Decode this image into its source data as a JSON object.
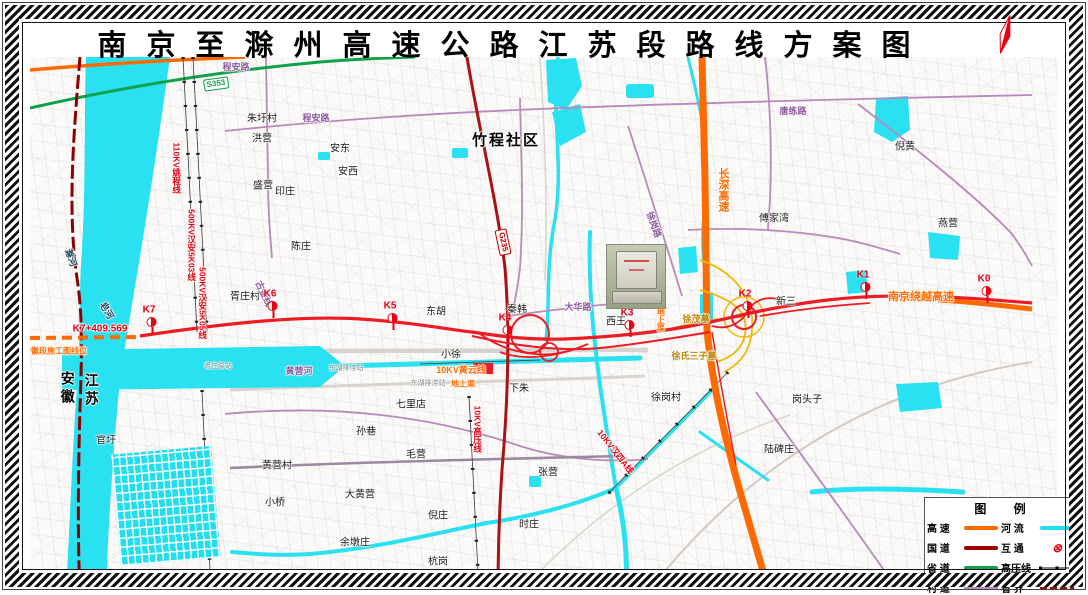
{
  "title": "南京至滁州高速公路江苏段路线方案图",
  "legend": {
    "title": "图 例",
    "items": [
      {
        "label": "高  速",
        "swatch": "line",
        "color": "#ff6a00"
      },
      {
        "label": "河  流",
        "swatch": "line",
        "color": "#22dff0"
      },
      {
        "label": "国  道",
        "swatch": "line",
        "color": "#a00000"
      },
      {
        "label": "互  通",
        "swatch": "interchange",
        "color": "#e60012"
      },
      {
        "label": "省  道",
        "swatch": "line",
        "color": "#11a04c"
      },
      {
        "label": "高压线",
        "swatch": "powerline",
        "color": "#000000"
      },
      {
        "label": "村  道",
        "swatch": "line",
        "color": "#b78ab8"
      },
      {
        "label": "省  界",
        "swatch": "dashed",
        "color": "#a00000"
      }
    ]
  },
  "map": {
    "stations": [
      {
        "id": "K0",
        "x": 987,
        "y": 303
      },
      {
        "id": "K1",
        "x": 866,
        "y": 299
      },
      {
        "id": "K2",
        "x": 748,
        "y": 318
      },
      {
        "id": "K3",
        "x": 630,
        "y": 337
      },
      {
        "id": "K4",
        "x": 508,
        "y": 342
      },
      {
        "id": "K5",
        "x": 393,
        "y": 330
      },
      {
        "id": "K6",
        "x": 273,
        "y": 318
      },
      {
        "id": "K7",
        "x": 152,
        "y": 334
      }
    ],
    "shields": [
      {
        "t": "S353",
        "x": 216,
        "y": 84,
        "cls": "green",
        "r": -8
      },
      {
        "t": "G235",
        "x": 503,
        "y": 242,
        "cls": "red",
        "r": 78
      }
    ],
    "labels": [
      {
        "t": "朱圩村",
        "x": 262,
        "y": 119,
        "c": "v"
      },
      {
        "t": "洪营",
        "x": 262,
        "y": 139,
        "c": "v"
      },
      {
        "t": "安东",
        "x": 340,
        "y": 149,
        "c": "v"
      },
      {
        "t": "安西",
        "x": 348,
        "y": 172,
        "c": "v"
      },
      {
        "t": "盛营",
        "x": 263,
        "y": 186,
        "c": "v"
      },
      {
        "t": "印庄",
        "x": 285,
        "y": 192,
        "c": "v"
      },
      {
        "t": "陈庄",
        "x": 301,
        "y": 247,
        "c": "v"
      },
      {
        "t": "胥庄村",
        "x": 245,
        "y": 297,
        "c": "v"
      },
      {
        "t": "竹程社区",
        "x": 506,
        "y": 141,
        "c": "vb"
      },
      {
        "t": "东胡",
        "x": 436,
        "y": 312,
        "c": "v"
      },
      {
        "t": "小徐",
        "x": 451,
        "y": 355,
        "c": "v"
      },
      {
        "t": "秦韩",
        "x": 517,
        "y": 310,
        "c": "v"
      },
      {
        "t": "西王",
        "x": 616,
        "y": 322,
        "c": "v"
      },
      {
        "t": "新三",
        "x": 786,
        "y": 302,
        "c": "v"
      },
      {
        "t": "傅家湾",
        "x": 774,
        "y": 219,
        "c": "v"
      },
      {
        "t": "燕营",
        "x": 948,
        "y": 224,
        "c": "v"
      },
      {
        "t": "倪黄",
        "x": 905,
        "y": 147,
        "c": "v"
      },
      {
        "t": "下朱",
        "x": 519,
        "y": 389,
        "c": "v"
      },
      {
        "t": "七里店",
        "x": 411,
        "y": 405,
        "c": "v"
      },
      {
        "t": "孙巷",
        "x": 366,
        "y": 432,
        "c": "v"
      },
      {
        "t": "毛营",
        "x": 416,
        "y": 455,
        "c": "v"
      },
      {
        "t": "黄营村",
        "x": 277,
        "y": 466,
        "c": "v"
      },
      {
        "t": "小桥",
        "x": 275,
        "y": 503,
        "c": "v"
      },
      {
        "t": "大黄营",
        "x": 360,
        "y": 495,
        "c": "v"
      },
      {
        "t": "倪庄",
        "x": 438,
        "y": 516,
        "c": "v"
      },
      {
        "t": "余墩庄",
        "x": 355,
        "y": 543,
        "c": "v"
      },
      {
        "t": "杭岗",
        "x": 438,
        "y": 562,
        "c": "v"
      },
      {
        "t": "张营",
        "x": 548,
        "y": 473,
        "c": "v"
      },
      {
        "t": "时庄",
        "x": 529,
        "y": 525,
        "c": "v"
      },
      {
        "t": "徐岗村",
        "x": 666,
        "y": 398,
        "c": "v"
      },
      {
        "t": "岗头子",
        "x": 807,
        "y": 400,
        "c": "v"
      },
      {
        "t": "陆碑庄",
        "x": 779,
        "y": 450,
        "c": "v"
      },
      {
        "t": "官圩",
        "x": 106,
        "y": 441,
        "c": "v"
      },
      {
        "t": "安徽",
        "x": 67,
        "y": 389,
        "c": "prov"
      },
      {
        "t": "江苏",
        "x": 91,
        "y": 391,
        "c": "prov"
      },
      {
        "t": "滁河",
        "x": 70,
        "y": 258,
        "c": "w",
        "r": 70
      },
      {
        "t": "皂河",
        "x": 106,
        "y": 311,
        "c": "w",
        "r": 60
      },
      {
        "t": "黄营河",
        "x": 299,
        "y": 372,
        "c": "p"
      },
      {
        "t": "程安路",
        "x": 236,
        "y": 68,
        "c": "p"
      },
      {
        "t": "程安路",
        "x": 316,
        "y": 119,
        "c": "p"
      },
      {
        "t": "唐练路",
        "x": 793,
        "y": 112,
        "c": "p"
      },
      {
        "t": "大华路",
        "x": 578,
        "y": 308,
        "c": "p"
      },
      {
        "t": "徐岗路",
        "x": 653,
        "y": 225,
        "c": "p",
        "r": 70
      },
      {
        "t": "古金线",
        "x": 263,
        "y": 294,
        "c": "p",
        "r": 65
      },
      {
        "t": "K7+409.569",
        "x": 100,
        "y": 329,
        "c": "r",
        "s": 10
      },
      {
        "t": "110KV姚程线",
        "x": 176,
        "y": 168,
        "c": "r",
        "vert": true
      },
      {
        "t": "500KV汉安5K03线",
        "x": 191,
        "y": 245,
        "c": "r",
        "vert": true
      },
      {
        "t": "500KV汉安5K05线",
        "x": 202,
        "y": 303,
        "c": "r",
        "vert": true
      },
      {
        "t": "10KV高压线",
        "x": 477,
        "y": 429,
        "c": "r",
        "vert": true
      },
      {
        "t": "10KV汉四A线",
        "x": 615,
        "y": 452,
        "c": "r",
        "r": 52
      },
      {
        "t": "长深高速",
        "x": 723,
        "y": 190,
        "c": "o",
        "vert": true,
        "s": 11
      },
      {
        "t": "南京绕越高速",
        "x": 921,
        "y": 297,
        "c": "o",
        "s": 11
      },
      {
        "t": "安徽段施工图线位",
        "x": 55,
        "y": 352,
        "c": "o",
        "s": 8
      },
      {
        "t": "10KV黄云线",
        "x": 461,
        "y": 371,
        "c": "o",
        "s": 9
      },
      {
        "t": "地上渠",
        "x": 463,
        "y": 385,
        "c": "o",
        "s": 8
      },
      {
        "t": "地上渠",
        "x": 660,
        "y": 320,
        "c": "o",
        "vert": true,
        "s": 8
      },
      {
        "t": "徐茂墓",
        "x": 696,
        "y": 320,
        "c": "y"
      },
      {
        "t": "徐氏三子墓",
        "x": 694,
        "y": 357,
        "c": "y"
      },
      {
        "t": "东湖排涝站",
        "x": 346,
        "y": 369,
        "c": "g"
      },
      {
        "t": "东湖排涝站",
        "x": 428,
        "y": 384,
        "c": "g"
      },
      {
        "t": "胥庄泵站",
        "x": 218,
        "y": 367,
        "c": "g"
      }
    ]
  }
}
